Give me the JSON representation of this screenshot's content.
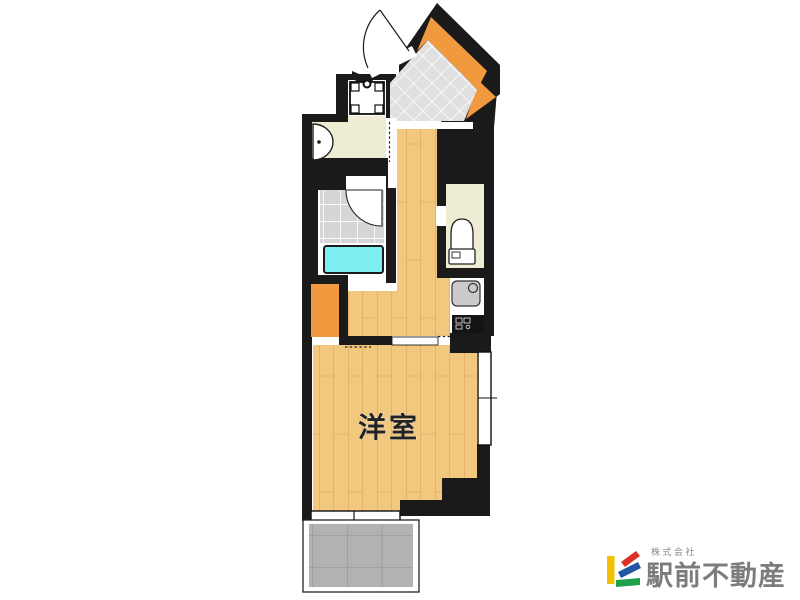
{
  "image": {
    "width": 800,
    "height": 600,
    "background": "#ffffff",
    "kind": "apartment floor plan"
  },
  "floorplan": {
    "room_label": "洋室",
    "colors": {
      "wall": "#1a1a1a",
      "wood": "#f1c87e",
      "wood_grain": "#d8a55c",
      "orange": "#f0993f",
      "entry_tile": "#e0e0e0",
      "bath_tile": "#d6d6d6",
      "tub": "#7deef0",
      "cream": "#efecd4",
      "balcony_tile": "#b2b2b2",
      "balcony_grout": "#909090",
      "fixture_gray": "#cbcbcb",
      "label_color": "#222222"
    }
  },
  "logo": {
    "company_prefix": "株式会社",
    "company_name": "駅前不動産",
    "text_color": "#7c7c7c",
    "prefix_color": "#8a8a8a",
    "mark": {
      "yellow": "#f2c200",
      "red": "#dc3126",
      "blue": "#2356a5",
      "green": "#21a04c"
    }
  }
}
